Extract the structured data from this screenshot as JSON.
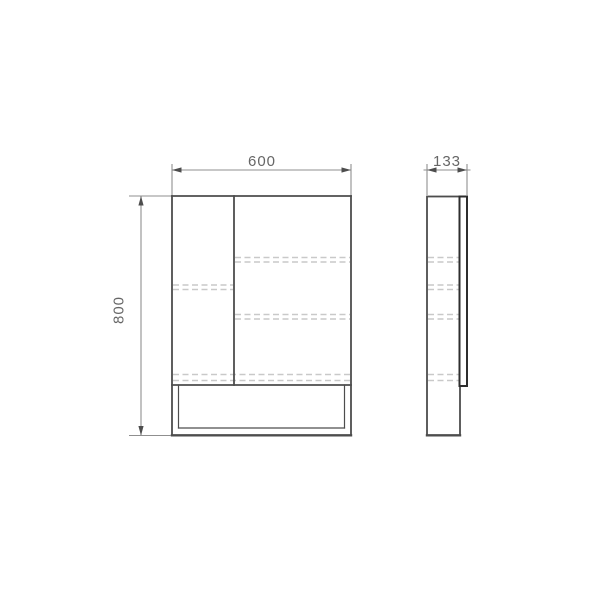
{
  "drawing": {
    "kind": "technical-dimension-drawing",
    "subject": "two-door mirror cabinet with open bottom niche, front and side orthographic views",
    "views": {
      "front": {
        "name": "front view",
        "features": [
          "left door",
          "right door",
          "open bottom shelf niche",
          "hidden shelf lines"
        ]
      },
      "side": {
        "name": "side view",
        "features": [
          "cabinet body",
          "door panel edge",
          "hidden shelf lines"
        ]
      }
    },
    "dimensions": {
      "width": {
        "label": "600",
        "applies_to": "front view width"
      },
      "height": {
        "label": "800",
        "applies_to": "front view height"
      },
      "depth": {
        "label": "133",
        "applies_to": "side view depth"
      }
    },
    "colors": {
      "background": "#ffffff",
      "outline": "#4d4d4d",
      "door_edge": "#2e2e2e",
      "dimension_line": "#8f8f8f",
      "dimension_text": "#666666",
      "hidden_line": "#c9c9c9"
    }
  }
}
